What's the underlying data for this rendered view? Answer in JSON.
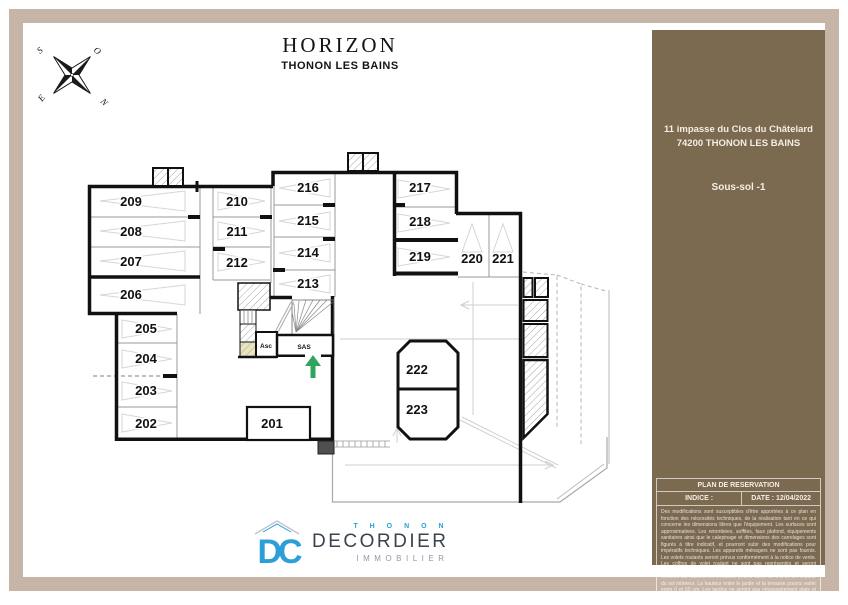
{
  "header": {
    "title": "HORIZON",
    "subtitle": "THONON LES BAINS"
  },
  "compass": {
    "top_left": "S",
    "top_right": "O",
    "bottom_left": "E",
    "bottom_right": "N"
  },
  "sidebar": {
    "bg_color": "#7b6950",
    "address_line1": "11 impasse du Clos du Châtelard",
    "address_line2": "74200 THONON LES BAINS",
    "level": "Sous-sol -1",
    "reservation_title": "PLAN DE RESERVATION",
    "indice_label": "INDICE :",
    "date_label": "DATE : 12/04/2022",
    "legal_text": "Des modifications sont susceptibles d'être apportées à ce plan en fonction des nécessités techniques, de la réalisation tant en ce qui concerne les dimensions libres que l'équipement. Les surfaces sont approximatives. Les retombées, soffites, faux plafond, équipements sanitaires ainsi que le calepinage et dimensions des carrelages sont figurés à titre indicatif, et pourront subir des modifications pour impératifs techniques. Les appareils ménagers ne sont pas fournis. Les volets roulants seront prévus conformément à la notice de vente. Les coffres de volet roulant ne sont pas représentés et seront débordant à l'intérieur. La hauteur des seuils au droit des portes-fenêtres sur balcons ou terrasses pourra varier de 5 à 35 cm à partir du sol intérieur. La hauteur entre le jardin et la terrasse pourra varier entre 0 et 60 cm. Les jardins ne seront pas nécessairement plats et pourront comporter des talus et des pentes."
  },
  "plan": {
    "entrance_arrow_color": "#2fa45e",
    "rooms": {
      "elevator_label": "Asc",
      "sas_label": "SAS"
    },
    "spaces": [
      {
        "id": "201"
      },
      {
        "id": "202"
      },
      {
        "id": "203"
      },
      {
        "id": "204"
      },
      {
        "id": "205"
      },
      {
        "id": "206"
      },
      {
        "id": "207"
      },
      {
        "id": "208"
      },
      {
        "id": "209"
      },
      {
        "id": "210"
      },
      {
        "id": "211"
      },
      {
        "id": "212"
      },
      {
        "id": "213"
      },
      {
        "id": "214"
      },
      {
        "id": "215"
      },
      {
        "id": "216"
      },
      {
        "id": "217"
      },
      {
        "id": "218"
      },
      {
        "id": "219"
      },
      {
        "id": "220"
      },
      {
        "id": "221"
      },
      {
        "id": "222"
      },
      {
        "id": "223"
      }
    ]
  },
  "logo": {
    "monogram": "DC",
    "brand_top": "T H O N O N",
    "brand": "DECORDIER",
    "brand_sub": "IMMOBILIER",
    "blue": "#2b9fd6"
  }
}
